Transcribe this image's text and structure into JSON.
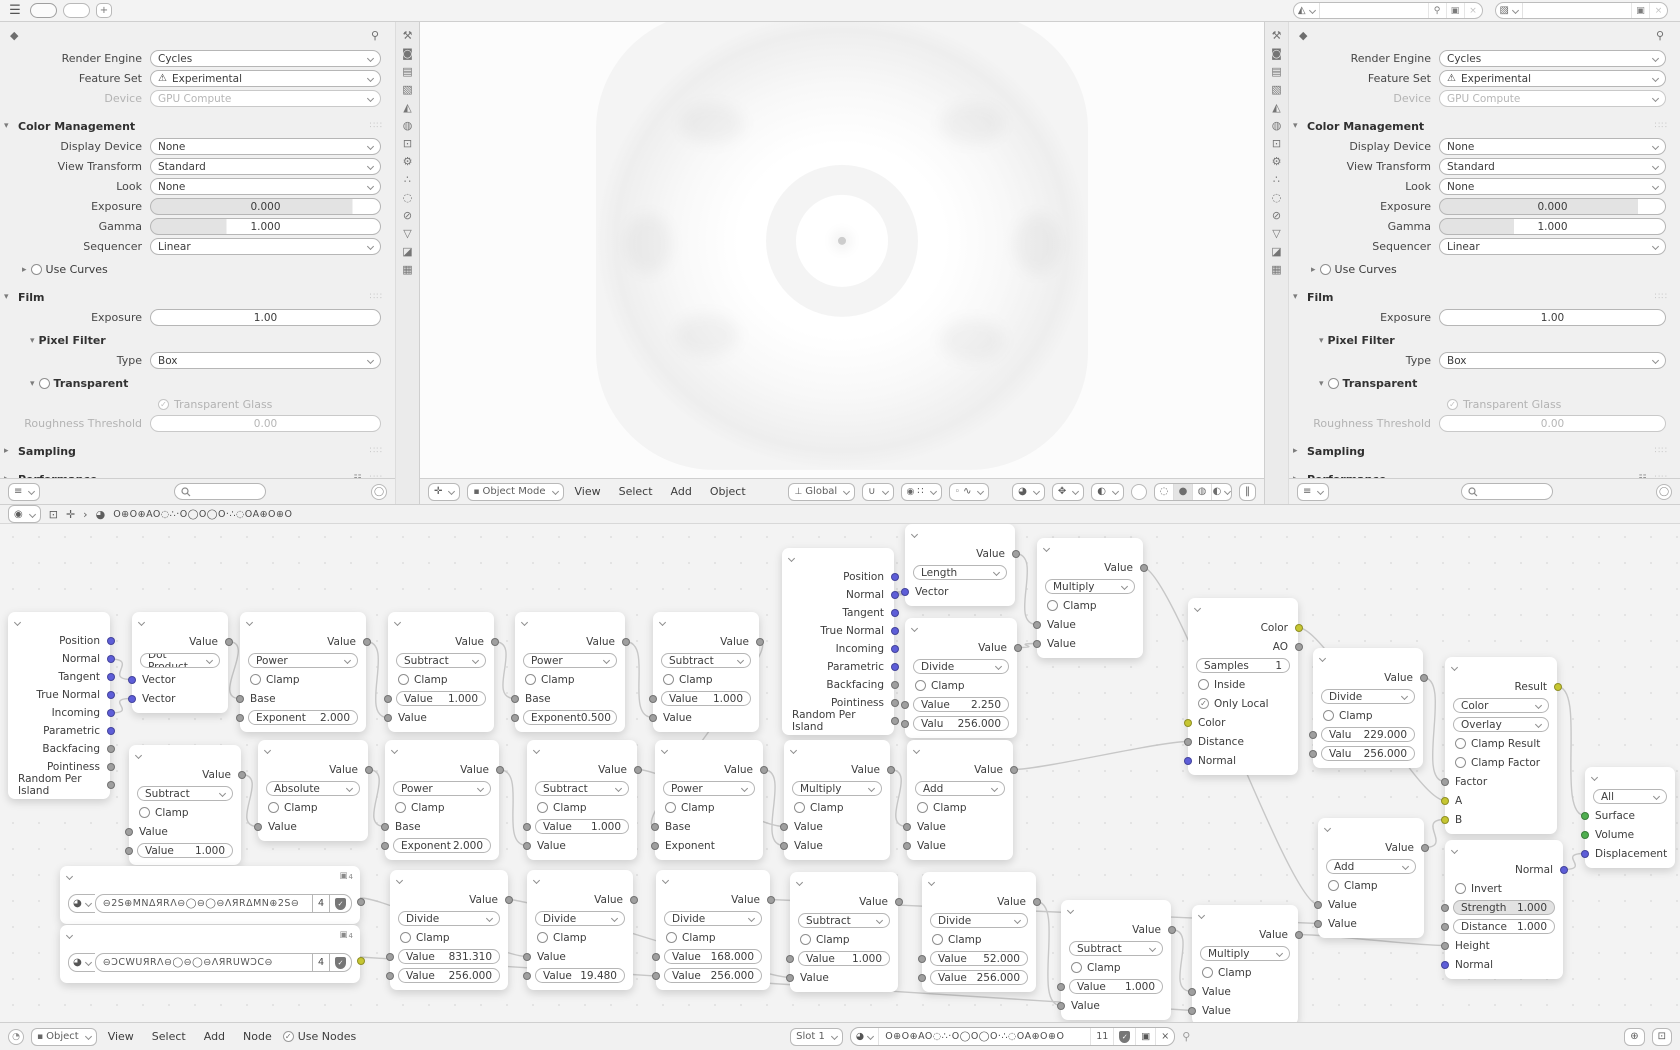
{
  "colors": {
    "g": "#9f9f9f",
    "v": "#5e5ed8",
    "y": "#c6c632",
    "e": "#4fae4f",
    "link": "#c7c7c7"
  },
  "topbar": {
    "menu_icon": "☰",
    "add_tab_label": "+",
    "scene_value": "",
    "view_layer_value": ""
  },
  "tab_icons": [
    {
      "name": "tool-icon",
      "glyph": "⚒"
    },
    {
      "name": "render-icon",
      "glyph": "◙"
    },
    {
      "name": "output-icon",
      "glyph": "▤"
    },
    {
      "name": "view-layer-icon",
      "glyph": "▧"
    },
    {
      "name": "scene-icon",
      "glyph": "◭"
    },
    {
      "name": "world-icon",
      "glyph": "◍"
    },
    {
      "name": "object-icon",
      "glyph": "⊡"
    },
    {
      "name": "modifiers-icon",
      "glyph": "⚙"
    },
    {
      "name": "particles-icon",
      "glyph": "∴"
    },
    {
      "name": "physics-icon",
      "glyph": "◌"
    },
    {
      "name": "constraints-icon",
      "glyph": "⊘"
    },
    {
      "name": "object-data-icon",
      "glyph": "▽"
    },
    {
      "name": "material-icon",
      "glyph": "◪"
    },
    {
      "name": "texture-icon",
      "glyph": "▦"
    }
  ],
  "properties": {
    "rows": [
      {
        "k": "row",
        "label": "Render Engine",
        "type": "dd",
        "value": "Cycles"
      },
      {
        "k": "row",
        "label": "Feature Set",
        "type": "dd",
        "value": "Experimental",
        "warn": true
      },
      {
        "k": "row",
        "label": "Device",
        "type": "dd",
        "value": "GPU Compute",
        "disabled": true
      },
      {
        "k": "header",
        "label": "Color Management",
        "open": true
      },
      {
        "k": "row",
        "label": "Display Device",
        "type": "dd",
        "value": "None"
      },
      {
        "k": "row",
        "label": "View Transform",
        "type": "dd",
        "value": "Standard"
      },
      {
        "k": "row",
        "label": "Look",
        "type": "dd",
        "value": "None"
      },
      {
        "k": "row",
        "label": "Exposure",
        "type": "slider",
        "value": "0.000",
        "fill": 88
      },
      {
        "k": "row",
        "label": "Gamma",
        "type": "slider",
        "value": "1.000",
        "fill": 33
      },
      {
        "k": "row",
        "label": "Sequencer",
        "type": "dd",
        "value": "Linear"
      },
      {
        "k": "sub",
        "label": "Use Curves",
        "open": false,
        "check": "off"
      },
      {
        "k": "header",
        "label": "Film",
        "open": true
      },
      {
        "k": "row",
        "label": "Exposure",
        "type": "plain",
        "value": "1.00"
      },
      {
        "k": "sub2",
        "label": "Pixel Filter",
        "open": true
      },
      {
        "k": "row",
        "label": "Type",
        "type": "dd",
        "value": "Box"
      },
      {
        "k": "sub2",
        "label": "Transparent",
        "open": true,
        "check": "off"
      },
      {
        "k": "checkrow",
        "label": "Transparent Glass",
        "checked": true,
        "disabled": true
      },
      {
        "k": "row",
        "label": "Roughness Threshold",
        "type": "plain",
        "value": "0.00",
        "disabled": true
      },
      {
        "k": "header",
        "label": "Sampling",
        "open": false
      },
      {
        "k": "header",
        "label": "Performance",
        "open": false,
        "list": true
      }
    ]
  },
  "viewport": {
    "mode": "Object Mode",
    "menus": [
      "View",
      "Select",
      "Add",
      "Object"
    ],
    "orientation": "Global"
  },
  "node_editor": {
    "tree_name": "O⊕O⊕AO◌∴·O◯O◯O·∴◌OA⊕O⊕O",
    "footer": {
      "object_type": "Object",
      "menus": [
        "View",
        "Select",
        "Add",
        "Node"
      ],
      "use_nodes_label": "Use Nodes",
      "slot_label": "Slot 1",
      "material_name": "O⊕O⊕AO◌∴·O◯O◯O·∴◌OA⊕O⊕O",
      "users_count": "11"
    }
  },
  "nodes": [
    {
      "x": 8,
      "y": 88,
      "w": 102,
      "rh": 18,
      "r": [
        [
          "o",
          "Position",
          "v"
        ],
        [
          "o",
          "Normal",
          "v"
        ],
        [
          "o",
          "Tangent",
          "v"
        ],
        [
          "o",
          "True Normal",
          "v"
        ],
        [
          "o",
          "Incoming",
          "v"
        ],
        [
          "o",
          "Parametric",
          "v"
        ],
        [
          "o",
          "Backfacing",
          "g"
        ],
        [
          "o",
          "Pointiness",
          "g"
        ],
        [
          "o",
          "Random Per Island",
          "g"
        ]
      ]
    },
    {
      "x": 132,
      "y": 88,
      "w": 96,
      "r": [
        [
          "o",
          "Value",
          "g"
        ],
        [
          "d",
          "Dot Product"
        ],
        [
          "i",
          "Vector",
          "v"
        ],
        [
          "i",
          "Vector",
          "v"
        ]
      ]
    },
    {
      "x": 240,
      "y": 88,
      "w": 126,
      "r": [
        [
          "o",
          "Value",
          "g"
        ],
        [
          "d",
          "Power"
        ],
        [
          "c",
          "Clamp"
        ],
        [
          "i",
          "Base",
          "g"
        ],
        [
          "f",
          "Exponent",
          "2.000",
          "g"
        ]
      ]
    },
    {
      "x": 388,
      "y": 88,
      "w": 106,
      "r": [
        [
          "o",
          "Value",
          "g"
        ],
        [
          "d",
          "Subtract"
        ],
        [
          "c",
          "Clamp"
        ],
        [
          "f",
          "Value",
          "1.000",
          "g"
        ],
        [
          "i",
          "Value",
          "g"
        ]
      ]
    },
    {
      "x": 515,
      "y": 88,
      "w": 110,
      "r": [
        [
          "o",
          "Value",
          "g"
        ],
        [
          "d",
          "Power"
        ],
        [
          "c",
          "Clamp"
        ],
        [
          "i",
          "Base",
          "g"
        ],
        [
          "f",
          "Exponent",
          "0.500",
          "g"
        ]
      ]
    },
    {
      "x": 653,
      "y": 88,
      "w": 106,
      "r": [
        [
          "o",
          "Value",
          "g"
        ],
        [
          "d",
          "Subtract"
        ],
        [
          "c",
          "Clamp"
        ],
        [
          "f",
          "Value",
          "1.000",
          "g"
        ],
        [
          "i",
          "Value",
          "g"
        ]
      ]
    },
    {
      "x": 782,
      "y": 24,
      "w": 112,
      "rh": 18,
      "r": [
        [
          "o",
          "Position",
          "v"
        ],
        [
          "o",
          "Normal",
          "v"
        ],
        [
          "o",
          "Tangent",
          "v"
        ],
        [
          "o",
          "True Normal",
          "v"
        ],
        [
          "o",
          "Incoming",
          "v"
        ],
        [
          "o",
          "Parametric",
          "v"
        ],
        [
          "o",
          "Backfacing",
          "g"
        ],
        [
          "o",
          "Pointiness",
          "g"
        ],
        [
          "o",
          "Random Per Island",
          "g"
        ]
      ]
    },
    {
      "x": 905,
      "y": 0,
      "w": 110,
      "r": [
        [
          "o",
          "Value",
          "g"
        ],
        [
          "d",
          "Length"
        ],
        [
          "i",
          "Vector",
          "v"
        ]
      ]
    },
    {
      "x": 1037,
      "y": 14,
      "w": 106,
      "r": [
        [
          "o",
          "Value",
          "g"
        ],
        [
          "d",
          "Multiply"
        ],
        [
          "c",
          "Clamp"
        ],
        [
          "i",
          "Value",
          "g"
        ],
        [
          "i",
          "Value",
          "g"
        ]
      ]
    },
    {
      "x": 905,
      "y": 94,
      "w": 112,
      "r": [
        [
          "o",
          "Value",
          "g"
        ],
        [
          "d",
          "Divide"
        ],
        [
          "c",
          "Clamp"
        ],
        [
          "f",
          "Value",
          "2.250",
          "g"
        ],
        [
          "f",
          "Valu",
          "256.000",
          "g"
        ]
      ]
    },
    {
      "x": 1188,
      "y": 74,
      "w": 110,
      "r": [
        [
          "o",
          "Color",
          "y"
        ],
        [
          "o",
          "AO",
          "g"
        ],
        [
          "m",
          "Samples",
          "1"
        ],
        [
          "c",
          "Inside"
        ],
        [
          "c",
          "Only Local",
          1
        ],
        [
          "i",
          "Color",
          "y"
        ],
        [
          "i",
          "Distance",
          "g"
        ],
        [
          "i",
          "Normal",
          "v"
        ]
      ]
    },
    {
      "x": 1313,
      "y": 124,
      "w": 110,
      "r": [
        [
          "o",
          "Value",
          "g"
        ],
        [
          "d",
          "Divide"
        ],
        [
          "c",
          "Clamp"
        ],
        [
          "f",
          "Valu",
          "229.000",
          "g"
        ],
        [
          "f",
          "Valu",
          "256.000",
          "g"
        ]
      ]
    },
    {
      "x": 1445,
      "y": 133,
      "w": 112,
      "r": [
        [
          "o",
          "Result",
          "y"
        ],
        [
          "d",
          "Color"
        ],
        [
          "d",
          "Overlay"
        ],
        [
          "c",
          "Clamp Result"
        ],
        [
          "c",
          "Clamp Factor"
        ],
        [
          "i",
          "Factor",
          "g"
        ],
        [
          "i",
          "A",
          "y"
        ],
        [
          "i",
          "B",
          "y"
        ]
      ]
    },
    {
      "x": 1585,
      "y": 243,
      "w": 90,
      "r": [
        [
          "d",
          "All"
        ],
        [
          "i",
          "Surface",
          "e"
        ],
        [
          "i",
          "Volume",
          "e"
        ],
        [
          "i",
          "Displacement",
          "v"
        ]
      ]
    },
    {
      "x": 1445,
      "y": 316,
      "w": 118,
      "r": [
        [
          "o",
          "Normal",
          "v"
        ],
        [
          "c",
          "Invert"
        ],
        [
          "s",
          "Strength",
          "1.000",
          "g"
        ],
        [
          "f",
          "Distance",
          "1.000",
          "g"
        ],
        [
          "i",
          "Height",
          "g"
        ],
        [
          "i",
          "Normal",
          "v"
        ]
      ]
    },
    {
      "x": 1318,
      "y": 294,
      "w": 106,
      "r": [
        [
          "o",
          "Value",
          "g"
        ],
        [
          "d",
          "Add"
        ],
        [
          "c",
          "Clamp"
        ],
        [
          "i",
          "Value",
          "g"
        ],
        [
          "i",
          "Value",
          "g"
        ]
      ]
    },
    {
      "x": 1061,
      "y": 376,
      "w": 110,
      "r": [
        [
          "o",
          "Value",
          "g"
        ],
        [
          "d",
          "Subtract"
        ],
        [
          "c",
          "Clamp"
        ],
        [
          "f",
          "Value",
          "1.000",
          "g"
        ],
        [
          "i",
          "Value",
          "g"
        ]
      ]
    },
    {
      "x": 1192,
      "y": 381,
      "w": 106,
      "r": [
        [
          "o",
          "Value",
          "g"
        ],
        [
          "d",
          "Multiply"
        ],
        [
          "c",
          "Clamp"
        ],
        [
          "i",
          "Value",
          "g"
        ],
        [
          "i",
          "Value",
          "g"
        ]
      ]
    },
    {
      "x": 129,
      "y": 221,
      "w": 112,
      "r": [
        [
          "o",
          "Value",
          "g"
        ],
        [
          "d",
          "Subtract"
        ],
        [
          "c",
          "Clamp"
        ],
        [
          "i",
          "Value",
          "g"
        ],
        [
          "f",
          "Value",
          "1.000",
          "g"
        ]
      ]
    },
    {
      "x": 258,
      "y": 216,
      "w": 110,
      "r": [
        [
          "o",
          "Value",
          "g"
        ],
        [
          "d",
          "Absolute"
        ],
        [
          "c",
          "Clamp"
        ],
        [
          "i",
          "Value",
          "g"
        ]
      ]
    },
    {
      "x": 385,
      "y": 216,
      "w": 114,
      "r": [
        [
          "o",
          "Value",
          "g"
        ],
        [
          "d",
          "Power"
        ],
        [
          "c",
          "Clamp"
        ],
        [
          "i",
          "Base",
          "g"
        ],
        [
          "f",
          "Exponent",
          "2.000",
          "g"
        ]
      ]
    },
    {
      "x": 527,
      "y": 216,
      "w": 110,
      "r": [
        [
          "o",
          "Value",
          "g"
        ],
        [
          "d",
          "Subtract"
        ],
        [
          "c",
          "Clamp"
        ],
        [
          "f",
          "Value",
          "1.000",
          "g"
        ],
        [
          "i",
          "Value",
          "g"
        ]
      ]
    },
    {
      "x": 655,
      "y": 216,
      "w": 108,
      "r": [
        [
          "o",
          "Value",
          "g"
        ],
        [
          "d",
          "Power"
        ],
        [
          "c",
          "Clamp"
        ],
        [
          "i",
          "Base",
          "g"
        ],
        [
          "i",
          "Exponent",
          "g"
        ]
      ]
    },
    {
      "x": 784,
      "y": 216,
      "w": 106,
      "r": [
        [
          "o",
          "Value",
          "g"
        ],
        [
          "d",
          "Multiply"
        ],
        [
          "c",
          "Clamp"
        ],
        [
          "i",
          "Value",
          "g"
        ],
        [
          "i",
          "Value",
          "g"
        ]
      ]
    },
    {
      "x": 907,
      "y": 216,
      "w": 106,
      "r": [
        [
          "o",
          "Value",
          "g"
        ],
        [
          "d",
          "Add"
        ],
        [
          "c",
          "Clamp"
        ],
        [
          "i",
          "Value",
          "g"
        ],
        [
          "i",
          "Value",
          "g"
        ]
      ]
    },
    {
      "script": true,
      "x": 60,
      "y": 342,
      "w": 300,
      "h": 58,
      "sy": 32,
      "name": "⊖2S⊕MNΔЯRΛ⊖◯⊖◯⊖ΛЯRΔMN⊕2S⊖",
      "users": "4",
      "badge": "4",
      "sock": "g"
    },
    {
      "script": true,
      "x": 60,
      "y": 401,
      "w": 300,
      "h": 58,
      "sy": 32,
      "name": "⊖ƆCWUЯRΛ⊖◯⊖◯⊖ΛЯRUWƆC⊖",
      "users": "4",
      "badge": "4",
      "sock": "y"
    },
    {
      "x": 390,
      "y": 346,
      "w": 118,
      "r": [
        [
          "o",
          "Value",
          "g"
        ],
        [
          "d",
          "Divide"
        ],
        [
          "c",
          "Clamp"
        ],
        [
          "f",
          "Value",
          "831.310",
          "g"
        ],
        [
          "f",
          "Value",
          "256.000",
          "g"
        ]
      ]
    },
    {
      "x": 527,
      "y": 346,
      "w": 106,
      "r": [
        [
          "o",
          "Value",
          "g"
        ],
        [
          "d",
          "Divide"
        ],
        [
          "c",
          "Clamp"
        ],
        [
          "i",
          "Value",
          "g"
        ],
        [
          "f",
          "Value",
          "19.480",
          "g"
        ]
      ]
    },
    {
      "x": 656,
      "y": 346,
      "w": 114,
      "r": [
        [
          "o",
          "Value",
          "g"
        ],
        [
          "d",
          "Divide"
        ],
        [
          "c",
          "Clamp"
        ],
        [
          "f",
          "Value",
          "168.000",
          "g"
        ],
        [
          "f",
          "Value",
          "256.000",
          "g"
        ]
      ]
    },
    {
      "x": 790,
      "y": 348,
      "w": 108,
      "r": [
        [
          "o",
          "Value",
          "g"
        ],
        [
          "d",
          "Subtract"
        ],
        [
          "c",
          "Clamp"
        ],
        [
          "f",
          "Value",
          "1.000",
          "g"
        ],
        [
          "i",
          "Value",
          "g"
        ]
      ]
    },
    {
      "x": 922,
      "y": 348,
      "w": 114,
      "r": [
        [
          "o",
          "Value",
          "g"
        ],
        [
          "d",
          "Divide"
        ],
        [
          "c",
          "Clamp"
        ],
        [
          "f",
          "Value",
          "52.000",
          "g"
        ],
        [
          "f",
          "Value",
          "256.000",
          "g"
        ]
      ]
    }
  ],
  "links": [
    [
      0,
      1,
      1,
      2
    ],
    [
      0,
      4,
      1,
      3
    ],
    [
      1,
      0,
      2,
      3
    ],
    [
      2,
      0,
      3,
      4
    ],
    [
      3,
      0,
      4,
      3
    ],
    [
      4,
      0,
      5,
      4
    ],
    [
      5,
      0,
      22,
      3
    ],
    [
      18,
      0,
      19,
      3
    ],
    [
      19,
      0,
      20,
      3
    ],
    [
      20,
      0,
      21,
      4
    ],
    [
      21,
      0,
      23,
      3
    ],
    [
      22,
      0,
      23,
      4
    ],
    [
      23,
      0,
      24,
      3
    ],
    [
      24,
      0,
      10,
      6
    ],
    [
      6,
      1,
      7,
      2
    ],
    [
      7,
      0,
      8,
      3
    ],
    [
      9,
      0,
      8,
      4
    ],
    [
      8,
      0,
      15,
      3
    ],
    [
      10,
      0,
      12,
      6
    ],
    [
      11,
      0,
      12,
      5
    ],
    [
      15,
      0,
      12,
      7
    ],
    [
      12,
      0,
      13,
      1
    ],
    [
      14,
      0,
      13,
      3
    ],
    [
      16,
      0,
      17,
      3
    ],
    [
      17,
      0,
      14,
      4
    ],
    [
      31,
      0,
      16,
      4
    ],
    [
      25,
      0,
      28,
      3
    ],
    [
      27,
      0,
      30,
      4
    ],
    [
      29,
      0,
      15,
      4
    ],
    [
      26,
      0,
      17,
      4
    ]
  ]
}
